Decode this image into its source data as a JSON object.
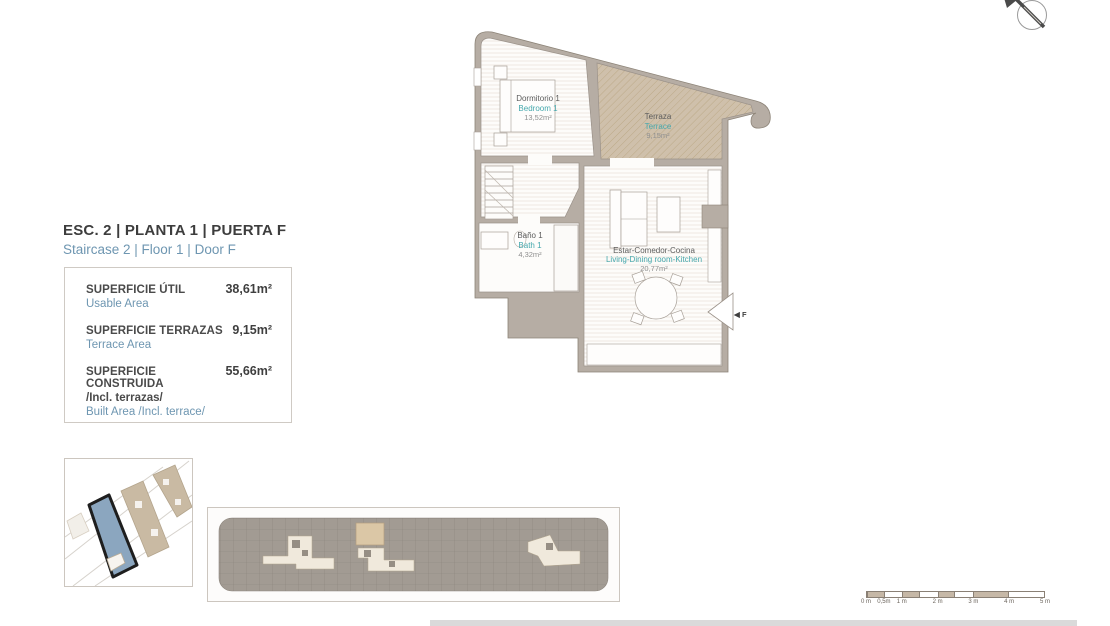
{
  "page": {
    "title": "ESC. 2 | PLANTA 1 | PUERTA F",
    "subtitle": "Staircase 2 | Floor 1 | Door F"
  },
  "areas": {
    "rows": [
      {
        "label_es": "SUPERFICIE ÚTIL",
        "label_en": "Usable Area",
        "value": "38,61m²"
      },
      {
        "label_es": "SUPERFICIE TERRAZAS",
        "label_en": "Terrace Area",
        "value": "9,15m²"
      },
      {
        "label_es": "SUPERFICIE CONSTRUIDA",
        "label_es_2": "/Incl. terrazas/",
        "label_en": "Built Area /Incl. terrace/",
        "value": "55,66m²"
      }
    ]
  },
  "floorplan": {
    "rooms": [
      {
        "name_es": "Dormitorio 1",
        "name_en": "Bedroom 1",
        "area": "13,52m²"
      },
      {
        "name_es": "Terraza",
        "name_en": "Terrace",
        "area": "9,15m²"
      },
      {
        "name_es": "Baño 1",
        "name_en": "Bath 1",
        "area": "4,32m²"
      },
      {
        "name_es": "Estar-Comedor-Cocina",
        "name_en": "Living-Dining room-Kitchen",
        "area": "20,77m²"
      }
    ],
    "entry": {
      "arrow": "◀",
      "label": "F"
    }
  },
  "scale_bar": {
    "labels": [
      "0 m",
      "0,5m",
      "1 m",
      "2 m",
      "3 m",
      "4 m",
      "5 m"
    ]
  },
  "colors": {
    "accent_blue": "#6e96b1",
    "accent_teal": "#45a8ad",
    "wall": "#b6ada4",
    "terrace_fill": "#cfc0ab",
    "site_highlight": "#8ba6bf"
  }
}
